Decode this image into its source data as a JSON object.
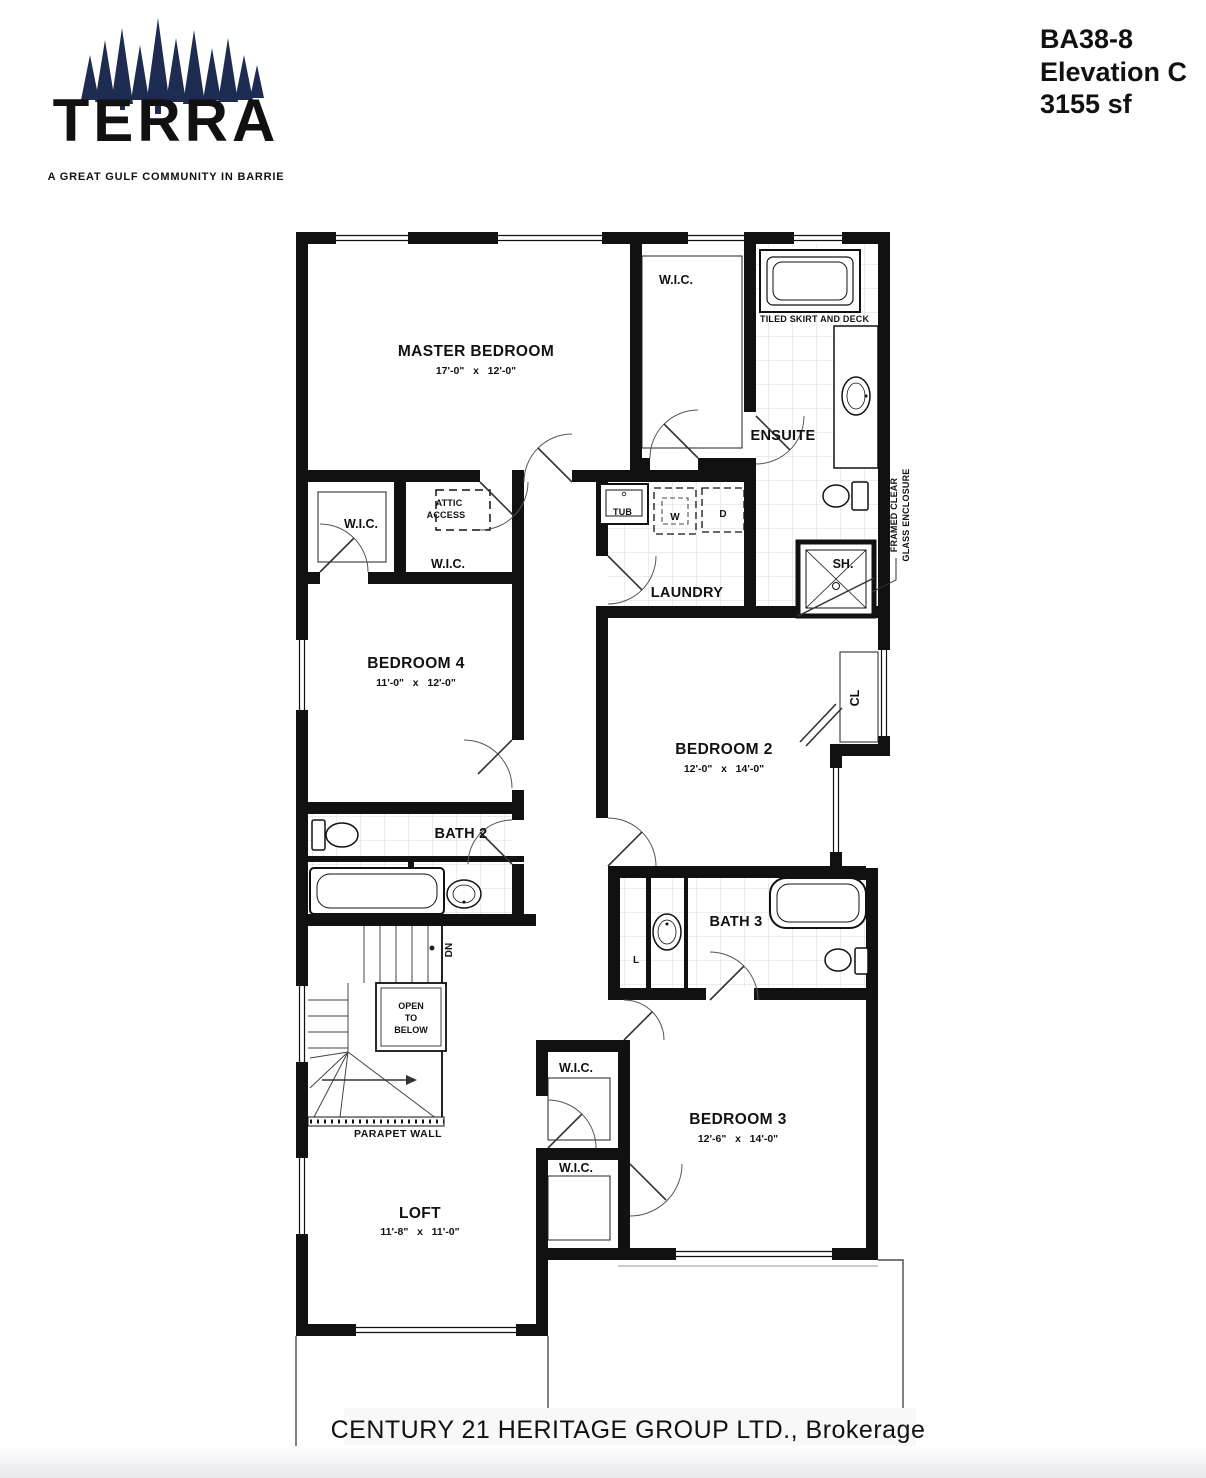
{
  "branding": {
    "logo_text": "TERRA",
    "tagline": "A GREAT GULF COMMUNITY IN BARRIE",
    "logo_color": "#e8392b",
    "trees_color": "#1e2c52"
  },
  "plan_info": {
    "model": "BA38-8",
    "elevation": "Elevation C",
    "area": "3155 sf"
  },
  "watermark": {
    "text": "CENTURY 21 HERITAGE GROUP LTD., Brokerage",
    "color": "#d4d4d6"
  },
  "colors": {
    "wall": "#111111",
    "tile_line": "#d9d9d9"
  },
  "rooms": {
    "master_bedroom": {
      "name": "MASTER BEDROOM",
      "dims": "17'-0\"   x   12'-0\""
    },
    "bedroom_2": {
      "name": "BEDROOM 2",
      "dims": "12'-0\"   x   14'-0\""
    },
    "bedroom_3": {
      "name": "BEDROOM 3",
      "dims": "12'-6\"   x   14'-0\""
    },
    "bedroom_4": {
      "name": "BEDROOM 4",
      "dims": "11'-0\"   x   12'-0\""
    },
    "loft": {
      "name": "LOFT",
      "dims": "11'-8\"   x   11'-0\""
    },
    "ensuite": "ENSUITE",
    "laundry": "LAUNDRY",
    "bath_2": "BATH 2",
    "bath_3": "BATH 3",
    "wic": "W.I.C.",
    "closet": "CL",
    "linen": "L"
  },
  "fixtures": {
    "laundry_tub": "TUB",
    "washer": "W",
    "dryer": "D",
    "shower": "SH."
  },
  "annotations": {
    "tiled_skirt_and_deck": "TILED SKIRT AND DECK",
    "attic_access_line1": "ATTIC",
    "attic_access_line2": "ACCESS",
    "glass_enclosure_line1": "FRAMED CLEAR",
    "glass_enclosure_line2": "GLASS ENCLOSURE",
    "open_to_below_line1": "OPEN",
    "open_to_below_line2": "TO",
    "open_to_below_line3": "BELOW",
    "down": "DN",
    "parapet_wall": "PARAPET WALL",
    "flat_roof_below": "FLAT ROOF BELOW"
  }
}
